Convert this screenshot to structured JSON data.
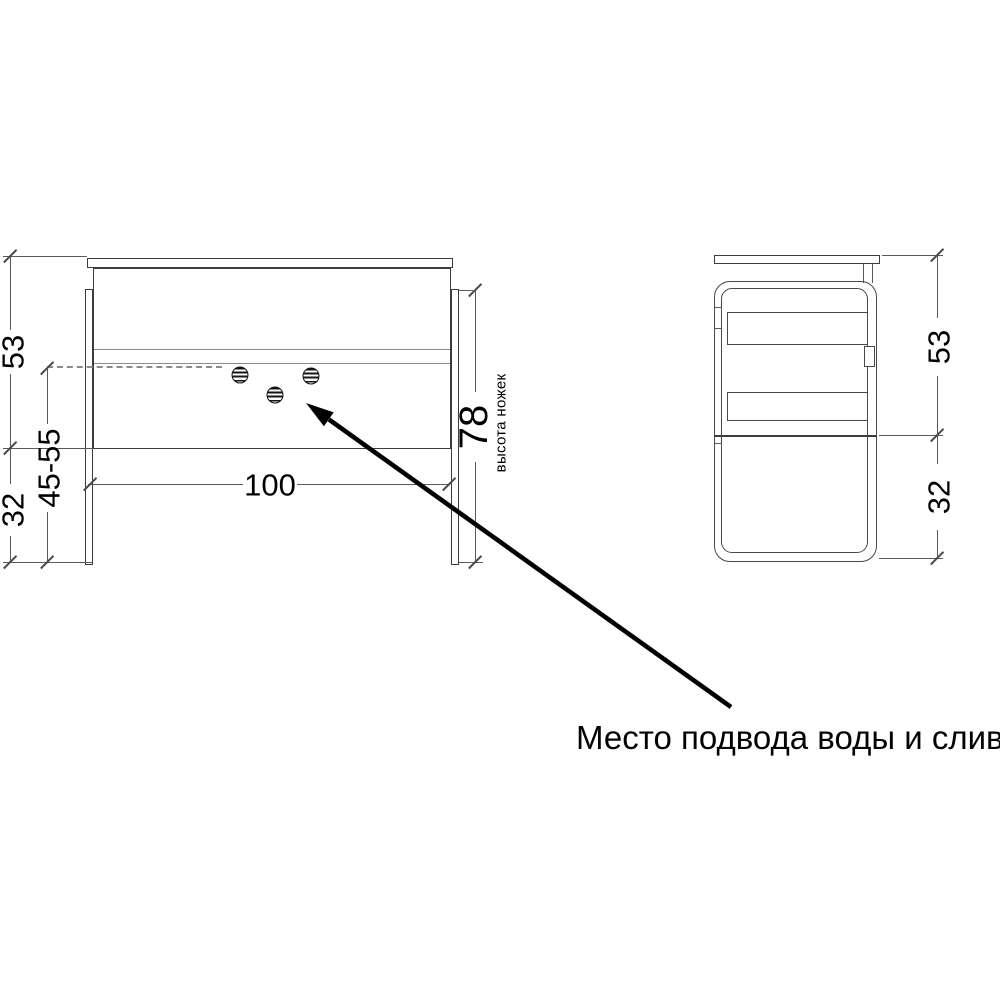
{
  "annotation": {
    "label": "Место подвода воды и слив"
  },
  "front_view": {
    "dim_top": "53",
    "dim_adjustable": "45-55",
    "dim_bottom": "32",
    "dim_width": "100",
    "dim_leg_height": "78",
    "leg_caption": "высота ножек"
  },
  "side_view": {
    "dim_top": "53",
    "dim_bottom": "32"
  },
  "colors": {
    "background": "#ffffff",
    "outline": "#3c3c3c",
    "dimension_line": "#5a5a5a",
    "dashed_line": "#8a8a8a",
    "text": "#000000",
    "arrow": "#000000"
  }
}
